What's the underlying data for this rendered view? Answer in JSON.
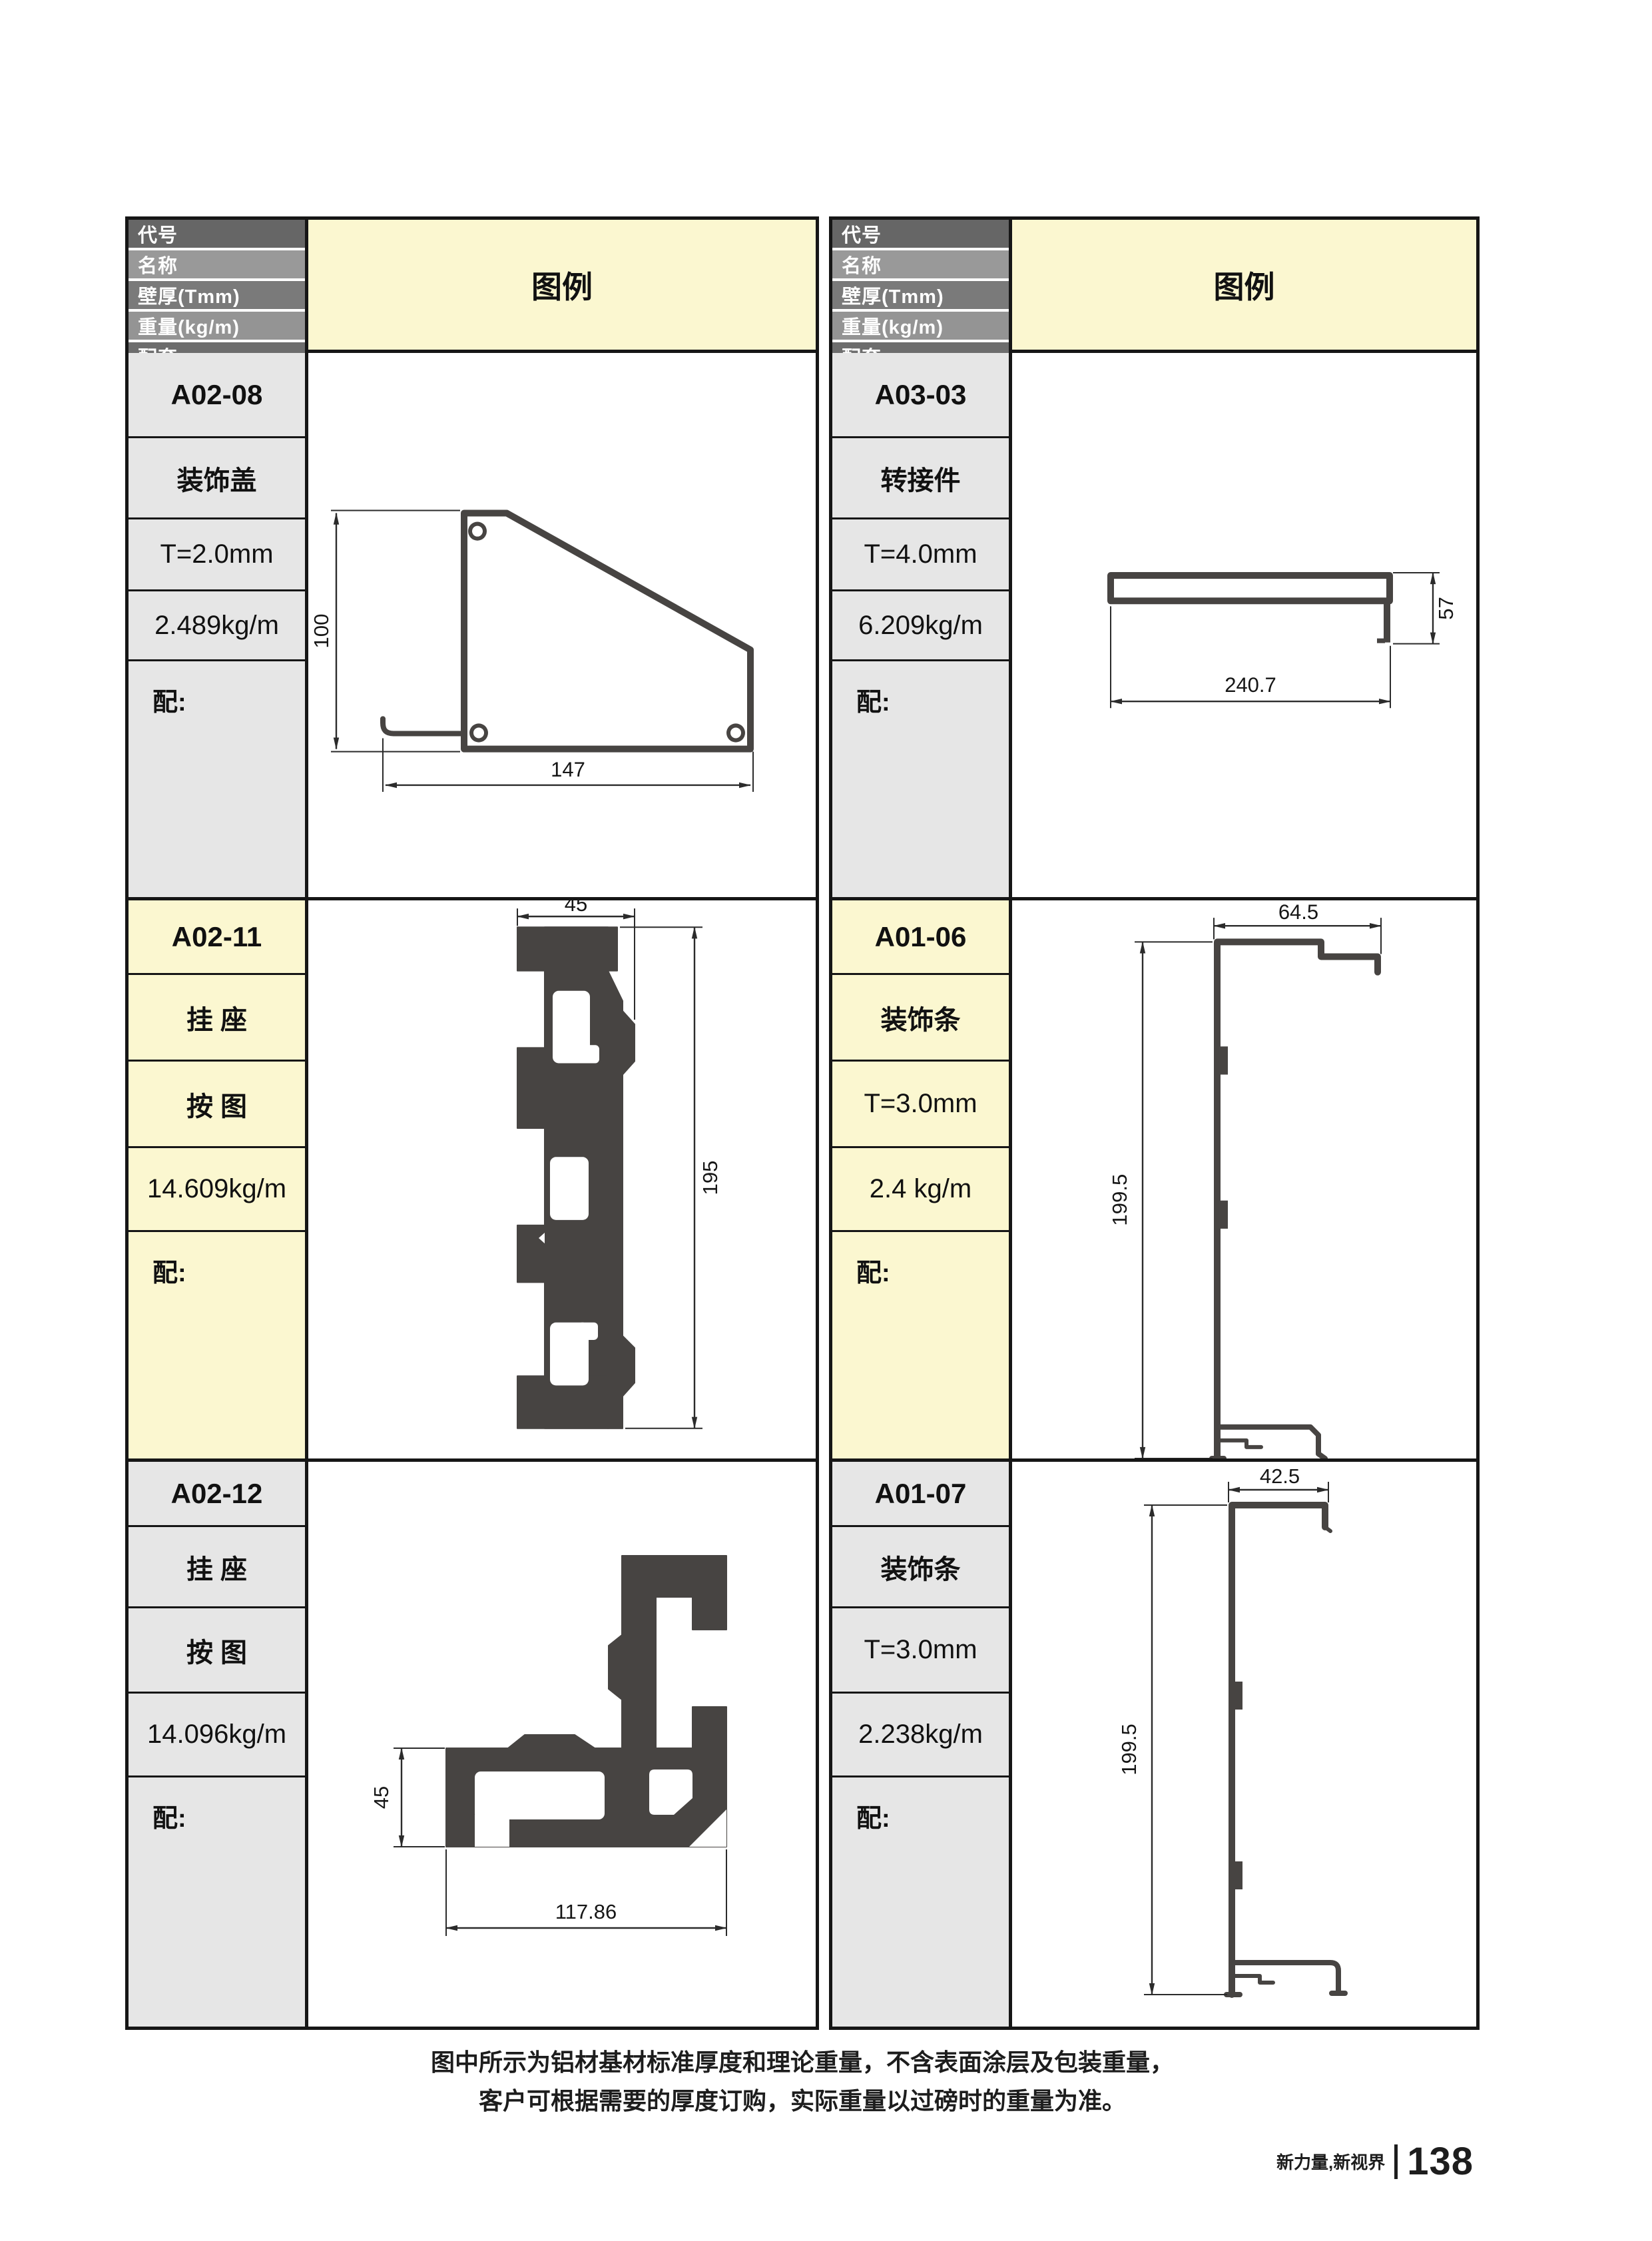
{
  "header_labels": [
    "代号",
    "名称",
    "壁厚(Tmm)",
    "重量(kg/m)",
    "配套"
  ],
  "legend_label": "图例",
  "profiles": [
    {
      "code": "A02-08",
      "name": "装饰盖",
      "thickness": "T=2.0mm",
      "weight": "2.489kg/m",
      "accessory": "配:",
      "dims": {
        "width": "147",
        "height": "100"
      }
    },
    {
      "code": "A03-03",
      "name": "转接件",
      "thickness": "T=4.0mm",
      "weight": "6.209kg/m",
      "accessory": "配:",
      "dims": {
        "width": "240.7",
        "height": "57"
      }
    },
    {
      "code": "A02-11",
      "name": "挂 座",
      "thickness": "按 图",
      "weight": "14.609kg/m",
      "accessory": "配:",
      "dims": {
        "width": "45",
        "height": "195"
      }
    },
    {
      "code": "A01-06",
      "name": "装饰条",
      "thickness": "T=3.0mm",
      "weight": "2.4 kg/m",
      "accessory": "配:",
      "dims": {
        "width": "64.5",
        "height": "199.5"
      }
    },
    {
      "code": "A02-12",
      "name": "挂 座",
      "thickness": "按 图",
      "weight": "14.096kg/m",
      "accessory": "配:",
      "dims": {
        "width": "117.86",
        "height": "45"
      }
    },
    {
      "code": "A01-07",
      "name": "装饰条",
      "thickness": "T=3.0mm",
      "weight": "2.238kg/m",
      "accessory": "配:",
      "dims": {
        "width": "42.5",
        "height": "199.5"
      }
    }
  ],
  "note": {
    "line1": "图中所示为铝材基材标准厚度和理论重量，不含表面涂层及包装重量，",
    "line2": "客户可根据需要的厚度订购，实际重量以过磅时的重量为准。"
  },
  "page_footer": {
    "slogan": "新力量,新视界",
    "page_number": "138"
  },
  "colors": {
    "grid_line": "#161616",
    "header_dark": "#666666",
    "header_light": "#999999",
    "legend_bg": "#fbf7d0",
    "cell_gray": "#e6e6e6",
    "cell_yellow": "#fbf7d0",
    "profile_fill": "#474442",
    "dimension_line": "#2b2b2b"
  }
}
